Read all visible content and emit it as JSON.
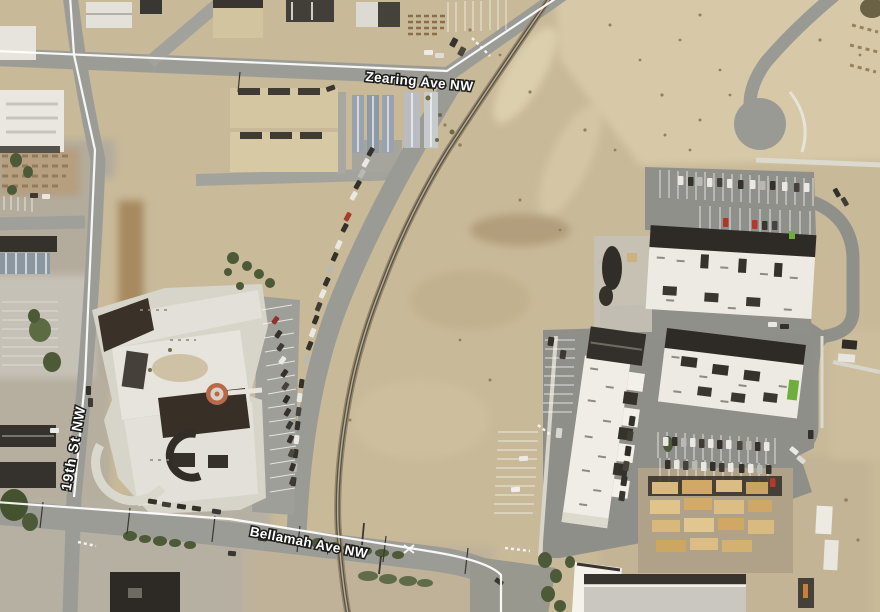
{
  "map": {
    "view": "satellite",
    "street_labels": {
      "zearing": "Zearing Ave NW",
      "bellamah": "Bellamah Ave NW",
      "nineteenth": "19th St NW"
    },
    "label_style": {
      "text_color": "#ffffff",
      "halo_color": "#1c1c1a"
    },
    "overlay": {
      "road_line_color": "#ffffff"
    },
    "palette": {
      "dirt": "#c8b998",
      "bright_sand": "#d7c9a8",
      "asphalt": "#9b9b96",
      "new_asphalt": "#8f8f8a",
      "concrete": "#d8d5cb",
      "white_roof": "#eceae2",
      "dark_roof": "#2e2b27",
      "tan_roof": "#d5c6a2",
      "blue_gray_roof": "#9aa3ad",
      "lumber": "#d8b97f",
      "vegetation": "#4d5a38",
      "rail_ties": "#97876a",
      "school_courtyard_ring": "#b86a48",
      "safety_green": "#6fae3d"
    }
  }
}
